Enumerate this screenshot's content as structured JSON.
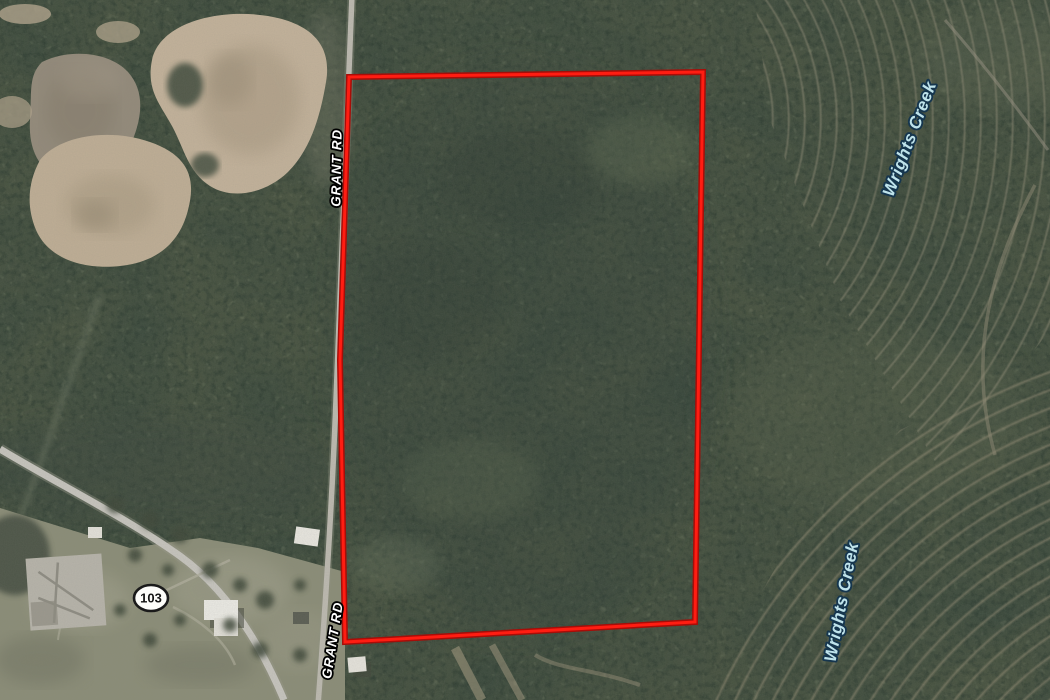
{
  "map": {
    "imagery_type": "aerial",
    "road_labels": [
      {
        "text": "GRANT RD"
      },
      {
        "text": "GRANT RD"
      }
    ],
    "water_labels": [
      {
        "text": "Wrights Creek"
      },
      {
        "text": "Wrights Creek"
      }
    ],
    "route_shield": {
      "number": "103"
    },
    "parcel_boundary": {
      "points": "349,77 703,72 695,622 345,642 340,360"
    }
  },
  "colors": {
    "boundary_red": "#ff1d12",
    "boundary_red_dark": "#a80d08",
    "road_label_fill": "#ffffff",
    "road_label_halo": "#000000",
    "water_label_fill": "#bfe3eb",
    "water_label_halo": "#16364e",
    "shield_fill": "#fdfdfa",
    "shield_border": "#1a1a1a",
    "forest_base": "#47523f",
    "field_tan": "#c3b29a",
    "road_gray": "#c2c0b8"
  }
}
